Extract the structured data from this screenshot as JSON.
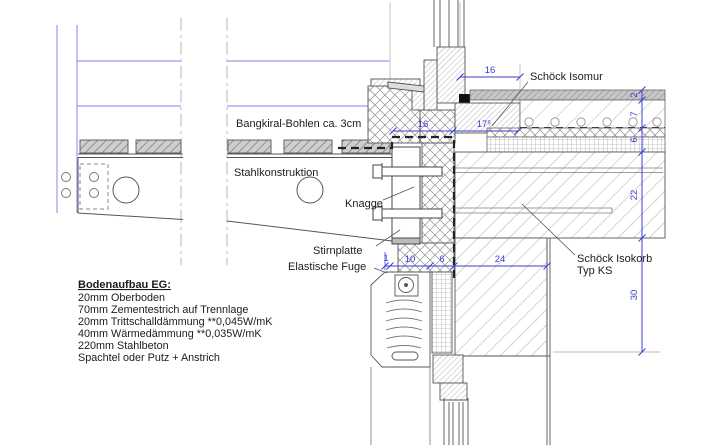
{
  "drawing": {
    "labels": {
      "bangkirai": "Bangkiral-Bohlen ca. 3cm",
      "stahl": "Stahlkonstruktion",
      "knagge": "Knagge",
      "stirnplatte": "Stirnplatte",
      "fuge": "Elastische Fuge",
      "isomur": "Schöck Isomur",
      "isokorb_line1": "Schöck Isokorb",
      "isokorb_line2": "Typ KS"
    },
    "legend": {
      "title": "Bodenaufbau EG:",
      "items": [
        "20mm Oberboden",
        "70mm Zementestrich auf Trennlage",
        "20mm Trittschalldämmung **0,045W/mK",
        "40mm Wärmedämmung **0,035W/mK",
        "220mm Stahlbeton",
        "Spachtel oder Putz + Anstrich"
      ]
    },
    "dims": {
      "top_16": "16",
      "mid_16": "16",
      "mid_17": "17⁵",
      "bot_1": "1",
      "bot_10": "10",
      "bot_6": "6",
      "bot_24": "24",
      "right_2": "2",
      "right_7": "7",
      "right_6": "6",
      "right_22": "22",
      "right_30": "30"
    },
    "colors": {
      "dimension_blue": "#3b3bd4",
      "railing_blue": "#9a9af0",
      "line_dark": "#444444",
      "hatch_grey": "#8f8f8f",
      "breakline_grey": "#b8b8b8"
    }
  }
}
